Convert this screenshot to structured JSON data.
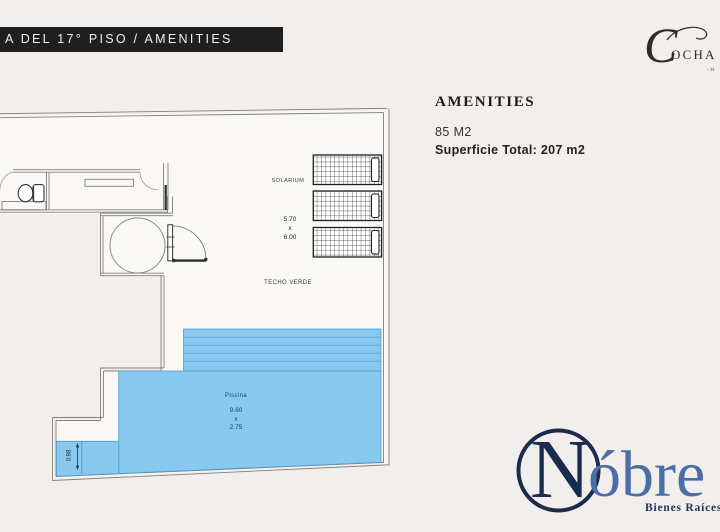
{
  "header": {
    "title": "A DEL 17°  PISO / AMENITIES"
  },
  "brand_top": {
    "initial": "C",
    "rest": "OCHA",
    "tagline_fragment": "- H"
  },
  "info": {
    "heading": "AMENITIES",
    "area": "85 M2",
    "total": "Superficie Total: 207 m2"
  },
  "plan": {
    "labels": {
      "solarium": "SOLARIUM",
      "techo_verde": "TECHO VERDE",
      "piscina": "Piscina"
    },
    "dimensions": {
      "solarium_width": "5.70",
      "solarium_sep": "x",
      "solarium_height": "6.00",
      "piscina_width": "9.60",
      "piscina_sep": "x",
      "piscina_height": "2.75",
      "ledge": "0.98"
    }
  },
  "brand_bottom": {
    "initial": "N",
    "rest": "óbre",
    "subtitle": "Bienes Raíces"
  },
  "colors": {
    "background": "#f1eeec",
    "floor": "#f9f8f4",
    "header_bg": "#1f1f1f",
    "wall": "#82807c",
    "pool_fill": "#87c9ef",
    "pool_stripe": "#62ade0",
    "pool_border": "#4d9dd1",
    "navy": "#1b2b4d",
    "steel_blue": "#4a6fa8"
  }
}
